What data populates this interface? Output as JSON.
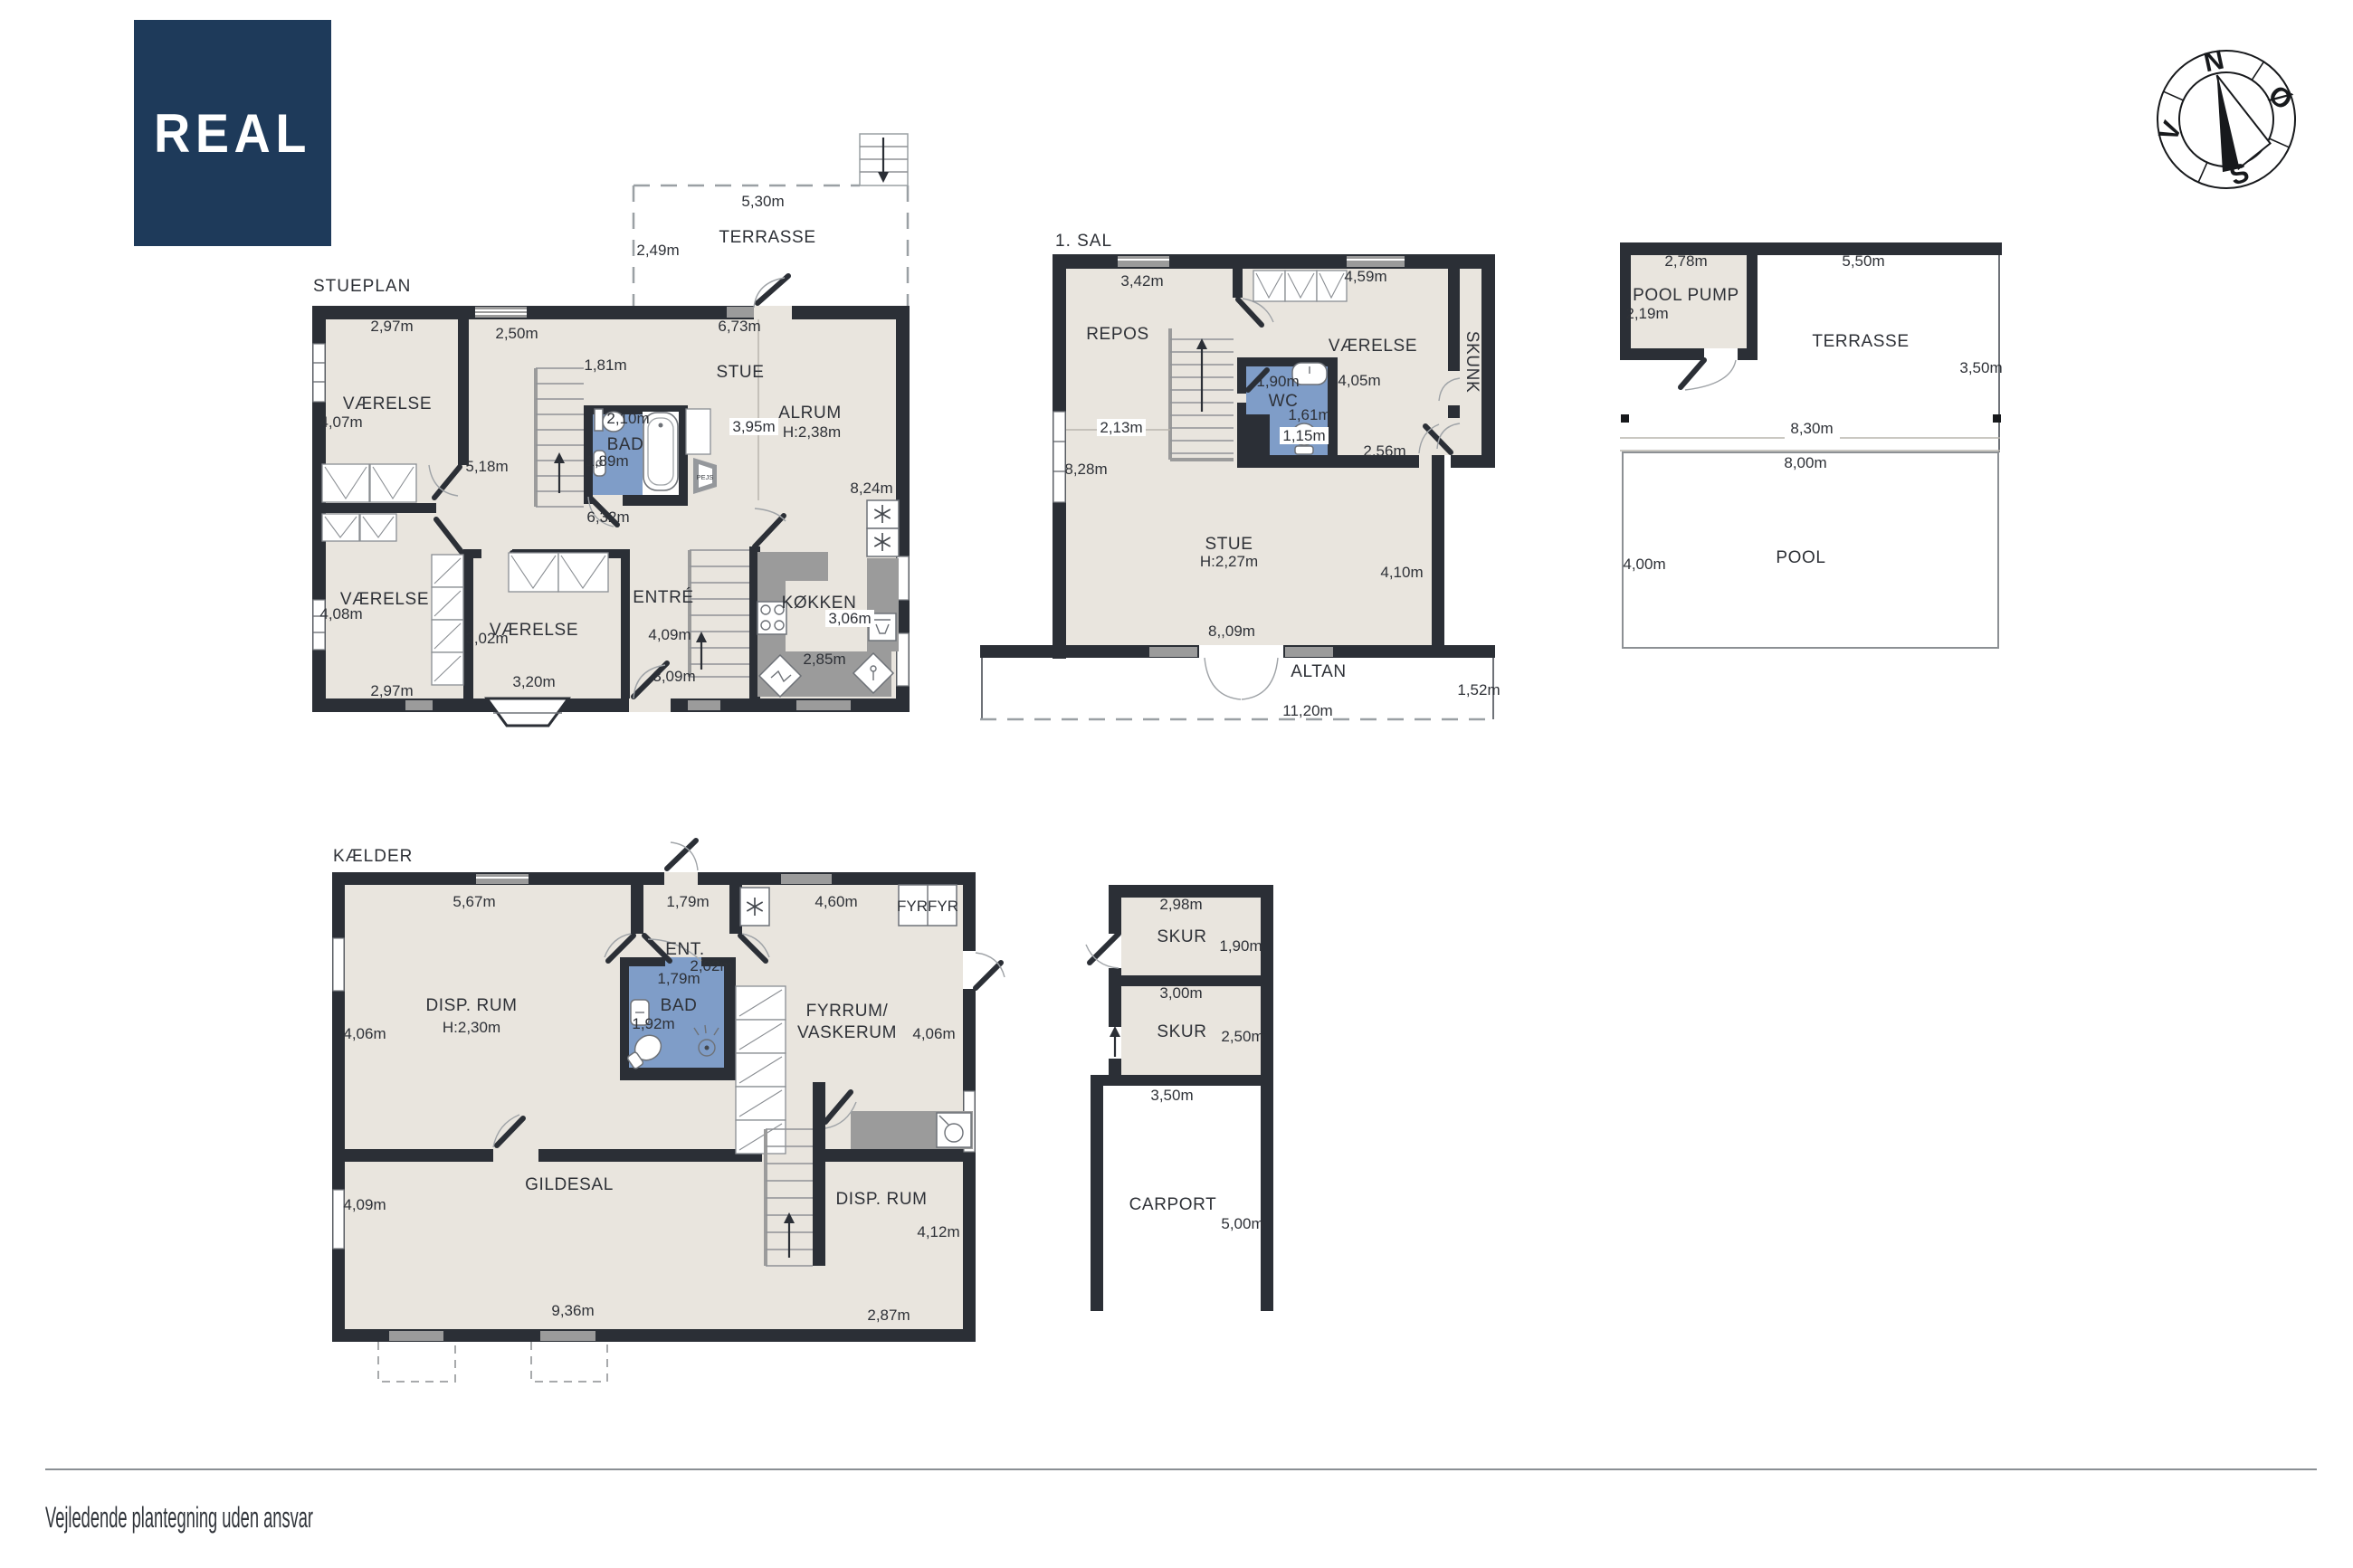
{
  "page": {
    "footer_disclaimer": "Vejledende plantegning uden ansvar"
  },
  "brand": {
    "logo_text": "REAL"
  },
  "compass": {
    "north": "N",
    "east": "Ø",
    "south": "S",
    "west": "V"
  },
  "colors": {
    "brand_navy": "#1e3a5a",
    "wall": "#2b2f36",
    "room_fill": "#e9e5de",
    "wet_room_fill": "#7f9dc8",
    "fixture_gray": "#9b9b9b",
    "text": "#2e3137"
  },
  "stueplan": {
    "title": "STUEPLAN",
    "terrasse": {
      "name": "TERRASSE",
      "width": "5,30m",
      "depth": "2,49m"
    },
    "vaerelse_nw": {
      "name": "VÆRELSE",
      "width": "2,97m",
      "height": "4,07m"
    },
    "hall": {
      "width": "2,50m",
      "depth": "1,81m",
      "length": "5,18m"
    },
    "stue": {
      "name": "STUE",
      "width": "6,73m"
    },
    "alrum": {
      "name": "ALRUM",
      "ceiling": "H:2,38m",
      "width": "3,95m",
      "height": "8,24m"
    },
    "bad": {
      "name": "BAD",
      "width": "2,10m",
      "depth": "1,89m",
      "below": "6,32m"
    },
    "vaerelse_sw": {
      "name": "VÆRELSE",
      "width": "2,97m",
      "height": "4,08m"
    },
    "vaerelse_s": {
      "name": "VÆRELSE",
      "width": "3,20m",
      "height": "3,02m"
    },
    "entre": {
      "name": "ENTRÉ",
      "height": "4,09m",
      "width": "3,09m"
    },
    "koekken": {
      "name": "KØKKEN",
      "width": "3,06m",
      "depth": "2,85m"
    },
    "pejs": {
      "name": "PEJS"
    }
  },
  "sal1": {
    "title": "1. SAL",
    "repos": {
      "name": "REPOS",
      "width": "3,42m",
      "depth": "2,13m"
    },
    "left_height": "8,28m",
    "vaerelse": {
      "name": "VÆRELSE",
      "width": "4,59m",
      "height": "4,05m"
    },
    "wc": {
      "name": "WC",
      "width": "1,90m",
      "depth": "1,61m",
      "width2": "1,15m"
    },
    "skunk": {
      "name": "SKUNK",
      "width": "2,56m"
    },
    "stue": {
      "name": "STUE",
      "ceiling": "H:2,27m",
      "height": "4,10m",
      "width": "8,,09m"
    },
    "altan": {
      "name": "ALTAN",
      "depth": "1,52m",
      "width": "11,20m"
    }
  },
  "pool_area": {
    "pool_pump": {
      "name": "POOL PUMP",
      "width": "2,78m",
      "height": "2,19m"
    },
    "terrasse": {
      "name": "TERRASSE",
      "width": "5,50m",
      "height": "3,50m"
    },
    "deck_width": "8,30m",
    "pool": {
      "name": "POOL",
      "width": "8,00m",
      "height": "4,00m"
    }
  },
  "kaelder": {
    "title": "KÆLDER",
    "disp_rum_nw": {
      "name": "DISP. RUM",
      "ceiling": "H:2,30m",
      "width": "5,67m",
      "height": "4,06m"
    },
    "ent": {
      "name": "ENT.",
      "width": "1,79m",
      "depth": "2,02m"
    },
    "fyr": {
      "name": "FYRFYR"
    },
    "fyrrum": {
      "name_line1": "FYRRUM/",
      "name_line2": "VASKERUM",
      "width": "4,60m",
      "height": "4,06m"
    },
    "bad": {
      "name": "BAD",
      "width": "1,79m",
      "depth": "1,92m"
    },
    "gildesal": {
      "name": "GILDESAL",
      "height": "4,09m",
      "width": "9,36m"
    },
    "disp_rum_se": {
      "name": "DISP. RUM",
      "height": "4,12m",
      "width": "2,87m"
    }
  },
  "outbuildings": {
    "skur_n": {
      "name": "SKUR",
      "width": "2,98m",
      "height": "1,90m"
    },
    "skur_s": {
      "name": "SKUR",
      "width": "3,00m",
      "height": "2,50m"
    },
    "carport": {
      "name": "CARPORT",
      "width": "3,50m",
      "height": "5,00m"
    }
  }
}
